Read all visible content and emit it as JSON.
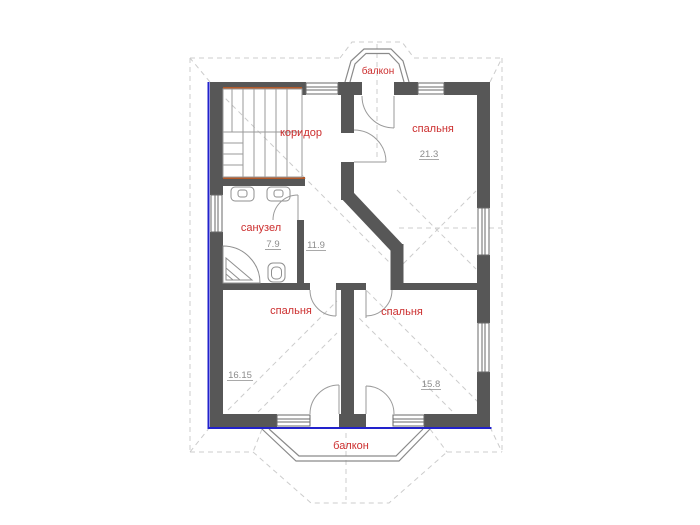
{
  "plan": {
    "rooms": {
      "corridor": {
        "label": "коридор",
        "area": "11.9"
      },
      "bedroom_top": {
        "label": "спальня",
        "area": "21.3"
      },
      "bathroom": {
        "label": "санузел",
        "area": "7.9"
      },
      "bedroom_left": {
        "label": "спальня",
        "area": "16.15"
      },
      "bedroom_right": {
        "label": "спальня",
        "area": "15.8"
      },
      "balcony_top": {
        "label": "балкон"
      },
      "balcony_bottom": {
        "label": "балкон"
      }
    },
    "colors": {
      "wall": "#575757",
      "accent_blue": "#2222cc",
      "label_red": "#cc2e2e",
      "area_gray": "#8c8c8c",
      "beam_orange": "#b45a2a",
      "window_frame": "#6a6a6a",
      "door": "#9a9a9a",
      "fixture": "#8f8f8f",
      "balcony_line": "#8a8a8a",
      "faint": "#cccccc",
      "stairs": "#9a9a9a",
      "background": "#ffffff"
    }
  }
}
